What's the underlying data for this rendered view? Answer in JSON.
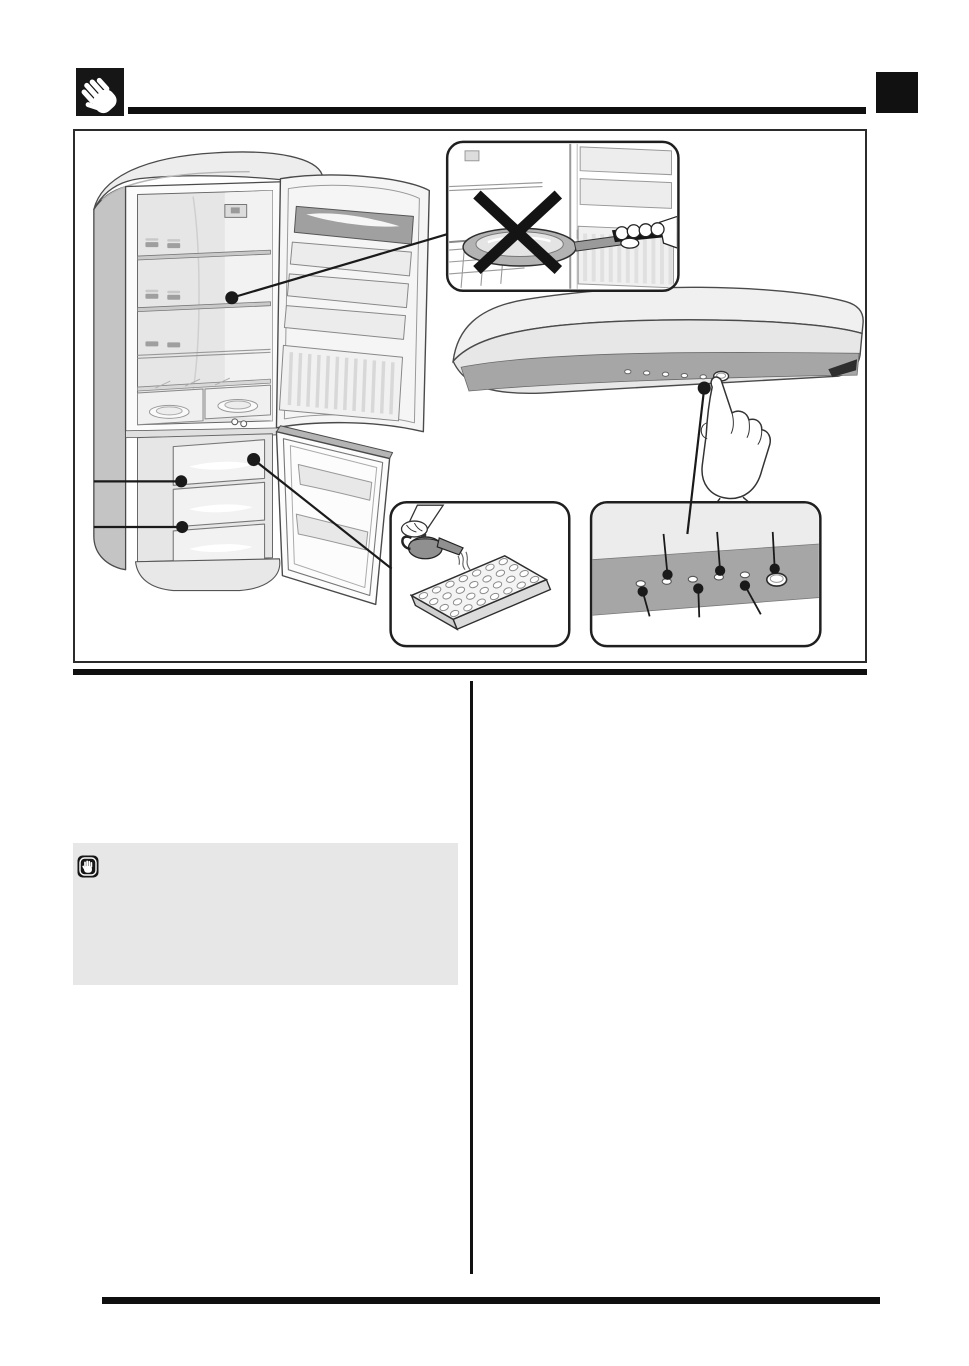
{
  "colors": {
    "page_bg": "#ffffff",
    "ink": "#111111",
    "rule": "#0f0f0f",
    "figure_border": "#2b2b2b",
    "note_box_bg": "#e7e7e7",
    "line_art": "#3c3c3c",
    "fill_light": "#f2f2f2",
    "fill_mid": "#d9d9d9",
    "fill_dark": "#a6a6a6"
  },
  "header": {
    "icon": "caution-hand-icon",
    "corner_marker": "solid-black-square"
  },
  "figure": {
    "main_illustration": "fridge-freezer-both-doors-open",
    "callout_dots": 6,
    "freezer_drawer_callouts": 2,
    "insets": [
      {
        "name": "no-hot-cookware-inside",
        "symbol": "prohibition-cross-icon"
      },
      {
        "name": "appliance-top-control-strip",
        "indicator_lights": 5,
        "buttons": 1,
        "gesture": "finger-pressing-button"
      },
      {
        "name": "filling-ice-cube-tray",
        "tray_cavity_columns": 7,
        "tray_cavity_rows": 4
      },
      {
        "name": "control-panel-detail",
        "indicator_lights": 5,
        "buttons": 1,
        "callouts_above": 3,
        "callouts_below": 3
      }
    ]
  },
  "note_box": {
    "icon": "stop-hand-icon"
  }
}
